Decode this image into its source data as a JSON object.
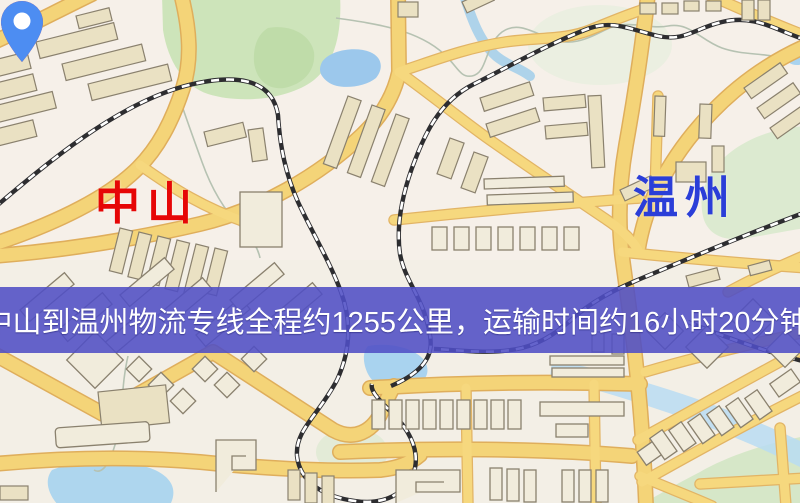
{
  "markers": {
    "origin": {
      "name": "中山",
      "pin_color": "#ee1c16",
      "pin_hole_color": "#ffffff",
      "label_color": "#e60606"
    },
    "destination": {
      "name": "温州",
      "pin_color": "#4d8df2",
      "pin_hole_color": "#ffffff",
      "label_color": "#2b3ed8"
    }
  },
  "banner": {
    "text": "中山到温州物流专线全程约1255公里，运输时间约16小时20分钟.",
    "background_color": "#504ec5",
    "text_color": "#ffffff"
  },
  "route": {
    "from": "中山",
    "to": "温州",
    "service": "物流专线",
    "distance_km": 1255,
    "duration": "16小时20分钟"
  },
  "map_colors": {
    "background": "#f3efe6",
    "road": "#f4d478",
    "railway": "#2d2d30",
    "park": "#cde4ba",
    "water": "#a9d3ef",
    "building": "#eae1c3"
  }
}
